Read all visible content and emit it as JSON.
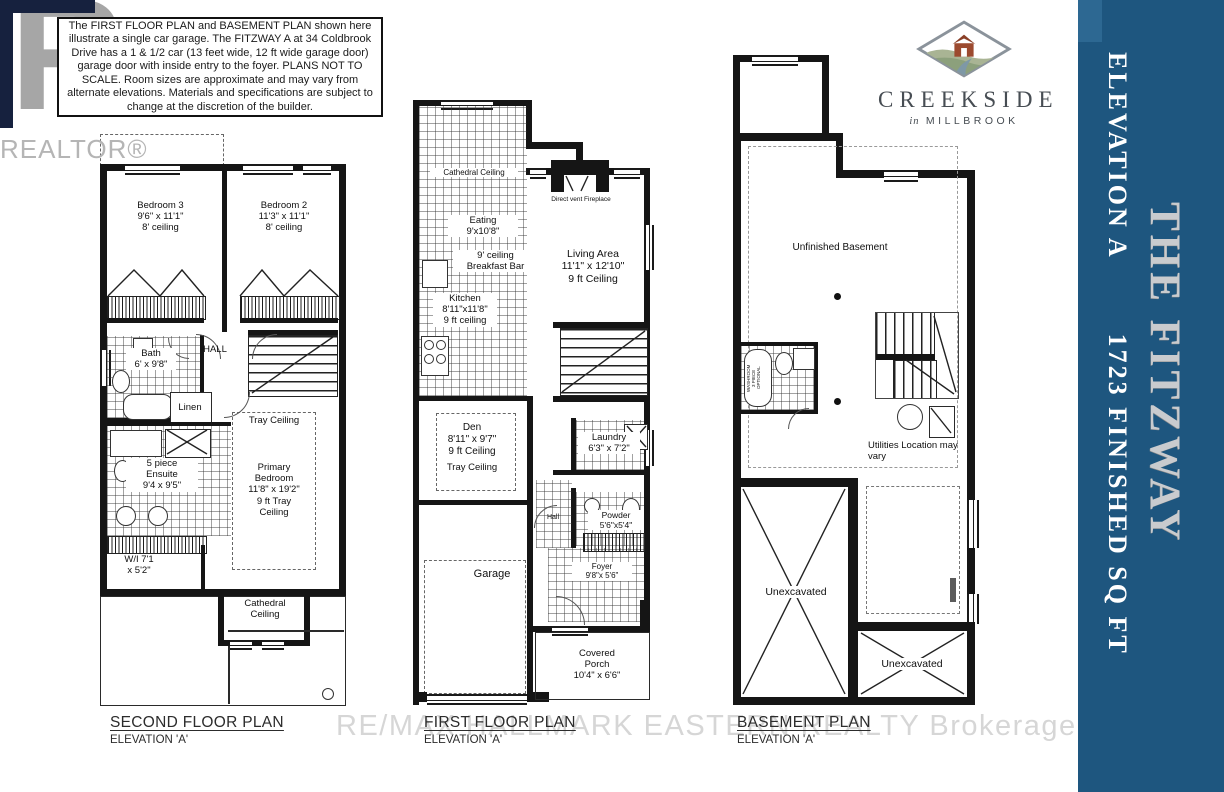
{
  "disclaimer": {
    "text": "The FIRST FLOOR PLAN and BASEMENT PLAN  shown here\nillustrate a single car garage.  The FITZWAY A at 34 Coldbrook\nDrive has a 1 & 1/2 car  (13 feet wide, 12 ft wide garage door)\ngarage door with inside entry to the foyer.   PLANS NOT TO\nSCALE.  Room sizes are approximate and may vary from\nalternate elevations.  Materials and specifications are subject to\nchange at the discretion of the builder."
  },
  "watermarks": {
    "realtor_letter": "R",
    "realtor_word": "REALTOR®",
    "brokerage": "RE/MAX HALLMARK EASTERN REALTY Brokerage"
  },
  "brand": {
    "name": "CREEKSIDE",
    "location_prefix": "in",
    "location": "MILLBROOK"
  },
  "sidebar": {
    "bg_color": "#1e567f",
    "elevation": "ELEVATION A",
    "sqft": "1723 FINISHED SQ FT",
    "model": "THE FITZWAY",
    "model_color_silver": "#c9cbce"
  },
  "plans": {
    "second": {
      "title": "SECOND FLOOR PLAN",
      "elevation": "ELEVATION 'A'",
      "rooms": {
        "bedroom3": "Bedroom 3\n9'6\" x 11'1\"\n8' ceiling",
        "bedroom2": "Bedroom 2\n11'3\" x 11'1\"\n8' ceiling",
        "hall": "HALL",
        "bath": "Bath\n6' x 9'8\"",
        "linen": "Linen",
        "tray_ceiling": "Tray Ceiling",
        "ensuite": "5 piece\nEnsuite\n9'4 x 9'5\"",
        "primary": "Primary\nBedroom\n11'8\" x 19'2\"\n9 ft Tray\nCeiling",
        "walkin": "W/I 7'1\nx 5'2\"",
        "cathedral": "Cathedral\nCeiling"
      }
    },
    "first": {
      "title": "FIRST FLOOR PLAN",
      "elevation": "ELEVATION 'A'",
      "rooms": {
        "cathedral": "Cathedral Ceiling",
        "eating": "Eating\n9'x10'8\"",
        "breakfast": "9' ceiling\nBreakfast Bar",
        "fireplace": "Direct vent Fireplace",
        "living": "Living Area\n11'1\" x 12'10\"\n9 ft Ceiling",
        "kitchen": "Kitchen\n8'11\"x11'8\"\n9 ft ceiling",
        "den": "Den\n8'11\" x 9'7\"\n9 ft Ceiling",
        "tray_ceiling": "Tray Ceiling",
        "laundry": "Laundry\n6'3\" x 7'2\"",
        "hall": "Hall",
        "powder": "Powder\n5'6\"x5'4\"",
        "garage": "Garage",
        "foyer": "Foyer\n9'8\"x 5'6\"",
        "porch": "Covered\nPorch\n10'4\" x 6'6\""
      }
    },
    "basement": {
      "title": "BASEMENT PLAN",
      "elevation": "ELEVATION 'A'",
      "rooms": {
        "unfinished": "Unfinished Basement",
        "washroom": "WASHROOM\n3 PIECE\nOPTIONAL",
        "utilities": "Utilities Location may\nvary",
        "unexcavated_left": "Unexcavated",
        "unexcavated_right": "Unexcavated"
      }
    }
  }
}
